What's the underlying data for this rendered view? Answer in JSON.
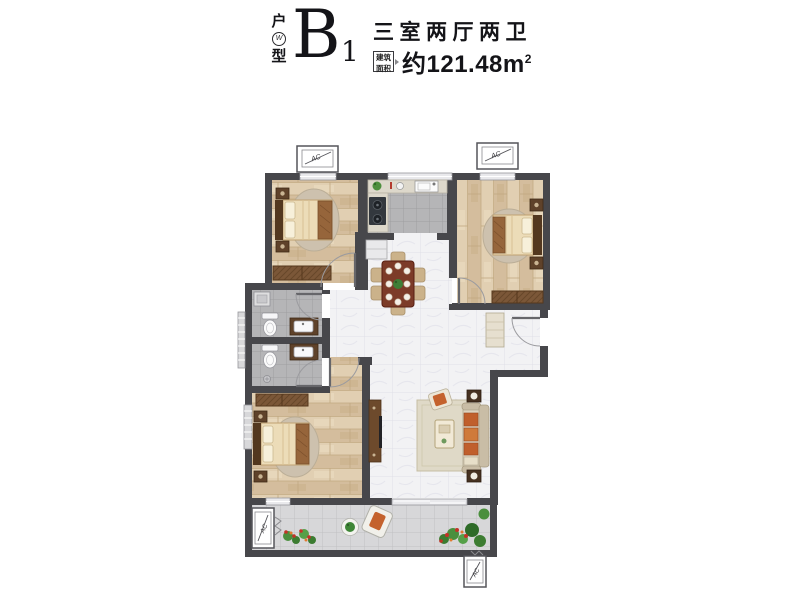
{
  "header": {
    "unit_type_top": "户",
    "unit_type_bottom": "型",
    "unit_type_mark": "W",
    "unit_code": "B",
    "unit_code_sub": "1",
    "layout_title": "三室两厅两卫",
    "area_label_line1": "建筑",
    "area_label_line2": "面积",
    "area_value": "约121.48m",
    "area_value_sup": "2"
  },
  "plan": {
    "ac_label": "AC",
    "colors": {
      "wall": "#47474b",
      "wood_floor": "#dbc7a9",
      "gray_tile_floor": "#b6b6b8",
      "marble_floor": "#f2f2f4",
      "balcony_tile": "#d7d7d9",
      "wardrobe_wood": "#7b5738",
      "bed_linen": "#ecdcb8",
      "sofa_accent_orange": "#c4622d",
      "plant_green": "#4a8f3d",
      "text_black": "#141418"
    }
  }
}
